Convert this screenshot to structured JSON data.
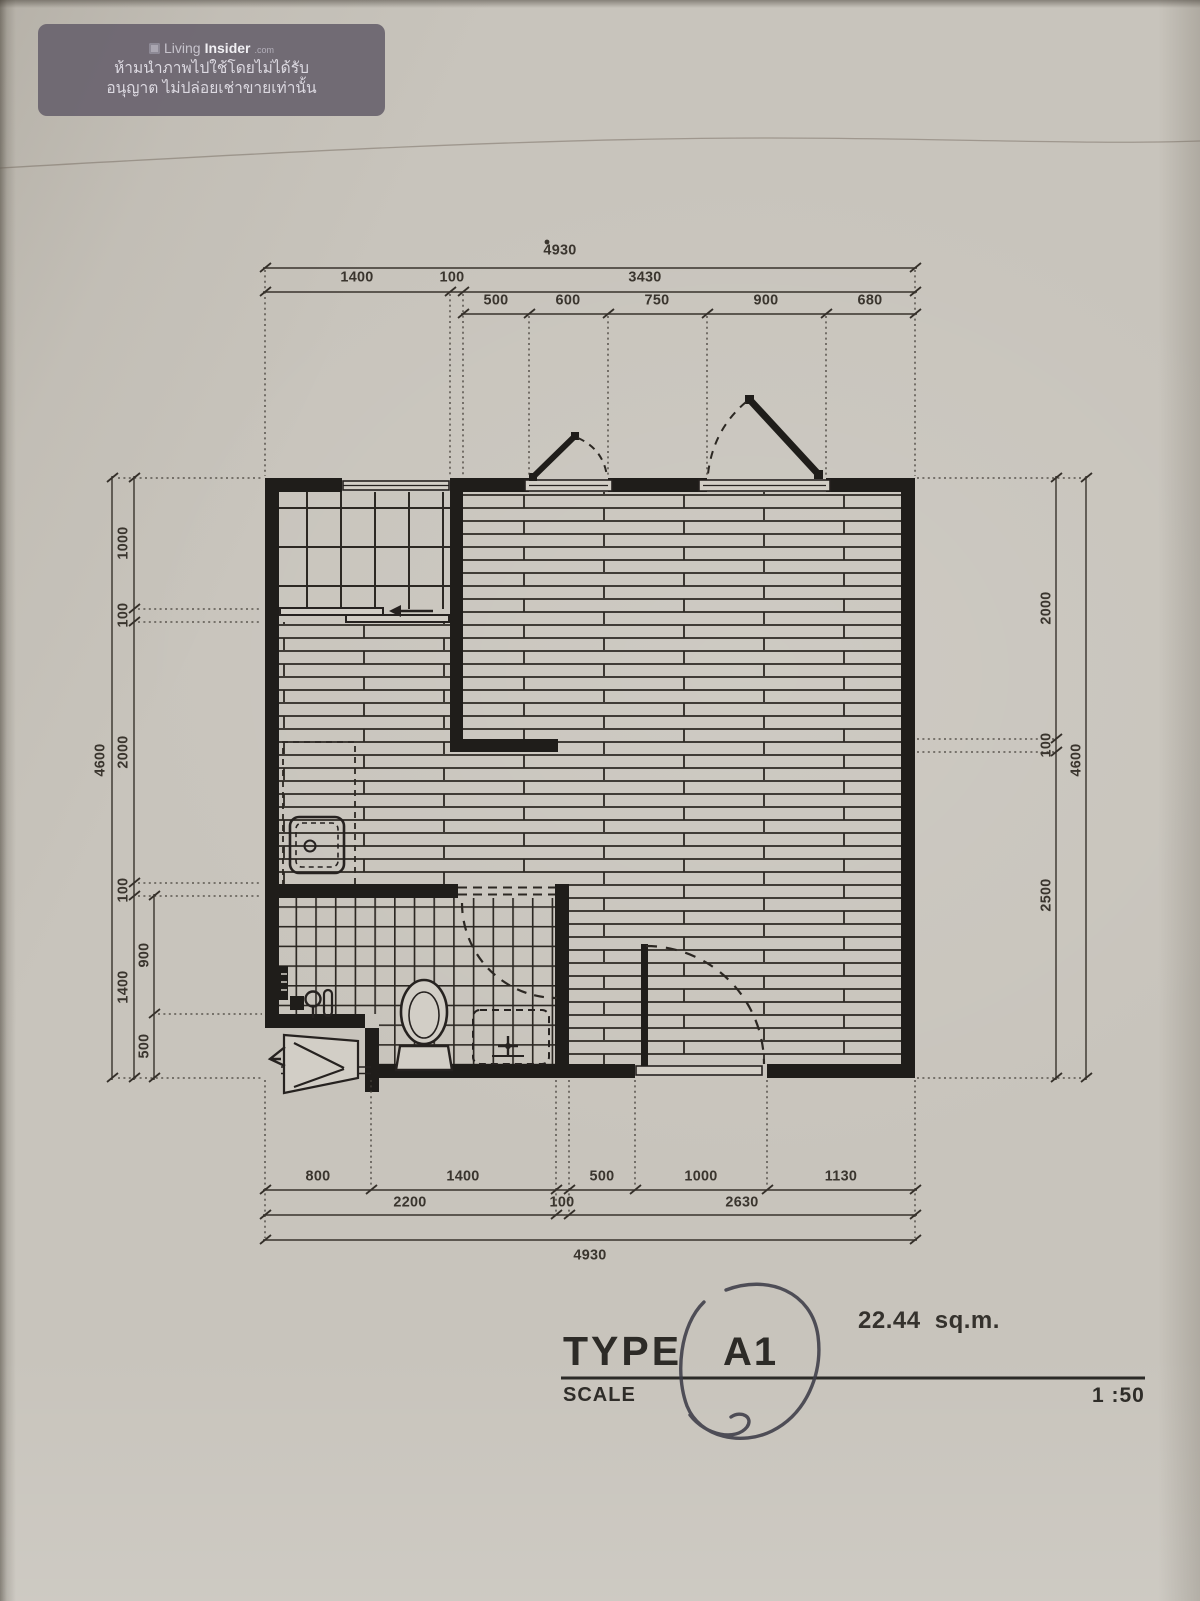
{
  "watermark": {
    "brand": {
      "living": "Living",
      "insider": "Insider",
      "tld": ".com"
    },
    "notice_line1": "ห้ามนำภาพไปใช้โดยไม่ได้รับ",
    "notice_line2": "อนุญาต ไม่ปล่อยเช่าขายเท่านั้น"
  },
  "dimensions": {
    "top": {
      "total": "4930",
      "row2": [
        "1400",
        "100",
        "3430"
      ],
      "row3": [
        "500",
        "600",
        "750",
        "900",
        "680"
      ]
    },
    "bottom": {
      "row1": [
        "800",
        "1400",
        "500",
        "1000",
        "1130"
      ],
      "row2": [
        "2200",
        "100",
        "2630"
      ],
      "total": "4930"
    },
    "left": {
      "total": "4600",
      "column": [
        "1000",
        "100",
        "2000",
        "100",
        "1400"
      ],
      "sub": [
        "900",
        "500"
      ]
    },
    "right": {
      "column": [
        "2000",
        "100",
        "2500"
      ],
      "total": "4600"
    }
  },
  "title_block": {
    "type_label": "TYPE",
    "type_value": "A1",
    "area": "22.44 sq.m.",
    "scale_label": "SCALE",
    "scale_value": "1 :50"
  }
}
